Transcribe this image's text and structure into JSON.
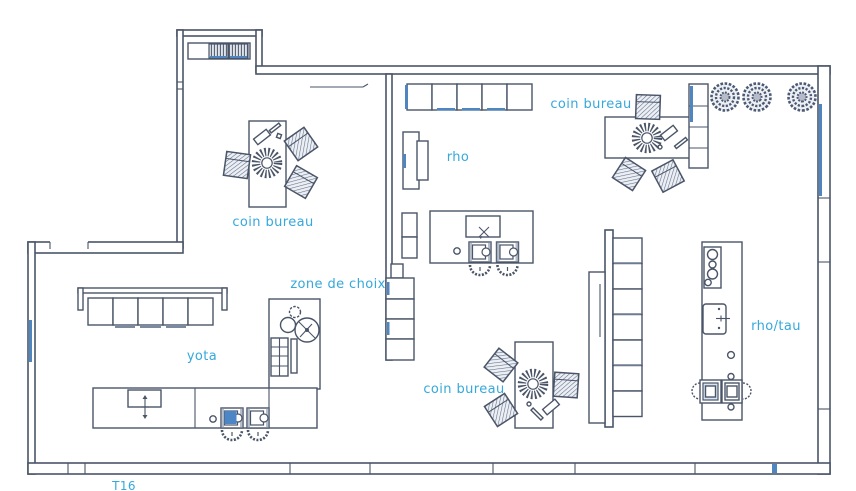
{
  "plan": {
    "labels": {
      "coin_bureau_top_left": "coin bureau",
      "rho": "rho",
      "coin_bureau_top_right": "coin bureau",
      "zone_de_choix": "zone de choix",
      "yota": "yota",
      "coin_bureau_bottom": "coin bureau",
      "rho_tau": "rho/tau",
      "t16": "T16"
    },
    "colors": {
      "label_text": "#35a8dc",
      "wall_line": "#4a5568",
      "glass_blue": "#4f86c0",
      "sink_fill": "#4d86c6"
    }
  }
}
